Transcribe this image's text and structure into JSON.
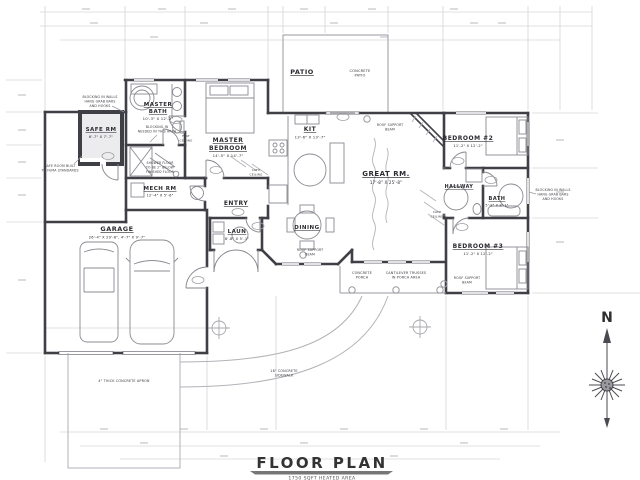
{
  "title": {
    "main": "FLOOR PLAN",
    "sub": "1750 SQFT HEATED AREA"
  },
  "compass": {
    "north": "N"
  },
  "colors": {
    "wall": "#3f3f46",
    "fixture": "#8b8b92",
    "faint": "#d4d4d8",
    "text": "#2b2b31"
  },
  "rooms": {
    "patio": {
      "name": "PATIO"
    },
    "master_bath": {
      "line1": "MASTER",
      "line2": "BATH",
      "dims": "10'-3\" X 12'-2\""
    },
    "master_bedroom": {
      "line1": "MASTER",
      "line2": "BEDROOM",
      "dims": "14'-5\" X 14'-7\""
    },
    "safe_rm": {
      "name": "SAFE RM",
      "dims": "6'-7\" X 7'-7\""
    },
    "mech_rm": {
      "name": "MECH RM",
      "dims": "12'-4\" X 5'-6\""
    },
    "entry": {
      "name": "ENTRY"
    },
    "laun": {
      "name": "LAUN",
      "dims": "8'-8\" X 5'-1\""
    },
    "dining": {
      "name": "DINING"
    },
    "kit": {
      "name": "KIT",
      "dims": "13'-6\" X 13'-7\""
    },
    "great_rm": {
      "name": "GREAT RM.",
      "dims": "17'-8\" X 25'-8\""
    },
    "bedroom2": {
      "name": "BEDROOM #2",
      "dims": "11'-2\" X 12'-2\""
    },
    "hallway": {
      "name": "HALLWAY"
    },
    "bath": {
      "name": "BATH",
      "dims": "5'-8\" X 8'-1\""
    },
    "bedroom3": {
      "name": "BEDROOM #3",
      "dims": "11'-2\" X 12'-2\""
    },
    "garage": {
      "name": "GARAGE",
      "dims": "26'-4\" X 29'-8\", 4'-7\" X 9'-7\""
    }
  },
  "notes": {
    "concrete_patio": [
      "CONCRETE",
      "PATIO"
    ],
    "blocking_left": [
      "BLOCKING IN WALLS",
      "HANG GRAB BARS",
      "AND HOOKS"
    ],
    "blocking_bath": [
      "BLOCKING IN",
      "NEEDED IN THIS AREA"
    ],
    "blocking_right": [
      "BLOCKING IN WALLS",
      "HANG GRAB BARS",
      "AND HOOKS"
    ],
    "safe_room": [
      "SAFE ROOM BUILT",
      "TO FEMA STANDARDS"
    ],
    "shower": [
      "SHOWER FLOOR",
      "TO BE 2\" BELOW",
      "FINISHED FLOOR"
    ],
    "roof_beam_great": [
      "ROOF SUPPORT",
      "BEAM"
    ],
    "roof_beam_dining": [
      "ROOF SUPPORT",
      "BEAM"
    ],
    "roof_beam_bed3": [
      "ROOF SUPPORT",
      "BEAM"
    ],
    "concrete_porch": [
      "CONCRETE",
      "PORCH"
    ],
    "cantilever": [
      "CANTILEVER TRUSSES",
      "IN PORCH AREA"
    ],
    "sidewalk": [
      "18\" CONCRETE",
      "SIDEWALK"
    ],
    "apron": [
      "4\" THICK CONCRETE APRON"
    ],
    "flat_ceiling": [
      "FLAT",
      "CEILING"
    ],
    "cath_ceiling_1": [
      "CATH",
      "CEILING"
    ],
    "cath_ceiling_2": [
      "CATH",
      "CEILING"
    ]
  }
}
